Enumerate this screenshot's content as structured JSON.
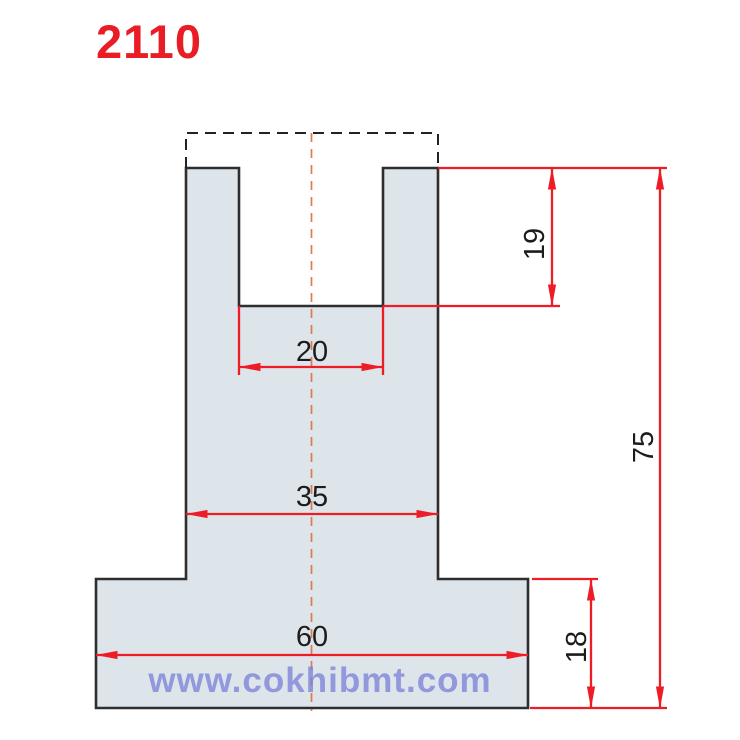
{
  "title": {
    "text": "2110",
    "color": "#e91d26"
  },
  "watermark": {
    "text": "www.cokhibmt.com",
    "color": "#7c83d8"
  },
  "drawing": {
    "description": "press-brake die cross-section, U-slot tool profile",
    "units": "mm",
    "fill_color": "#dde4ea",
    "outline_color": "#2e2e2e",
    "dimension_color": "#ee1c25",
    "centerline_color": "#db7b50",
    "dashed_extension_color": "#222222",
    "dimensions": {
      "slot_depth": "19",
      "slot_width": "20",
      "shank_width": "35",
      "overall_height": "75",
      "base_width": "60",
      "base_height": "18"
    }
  }
}
